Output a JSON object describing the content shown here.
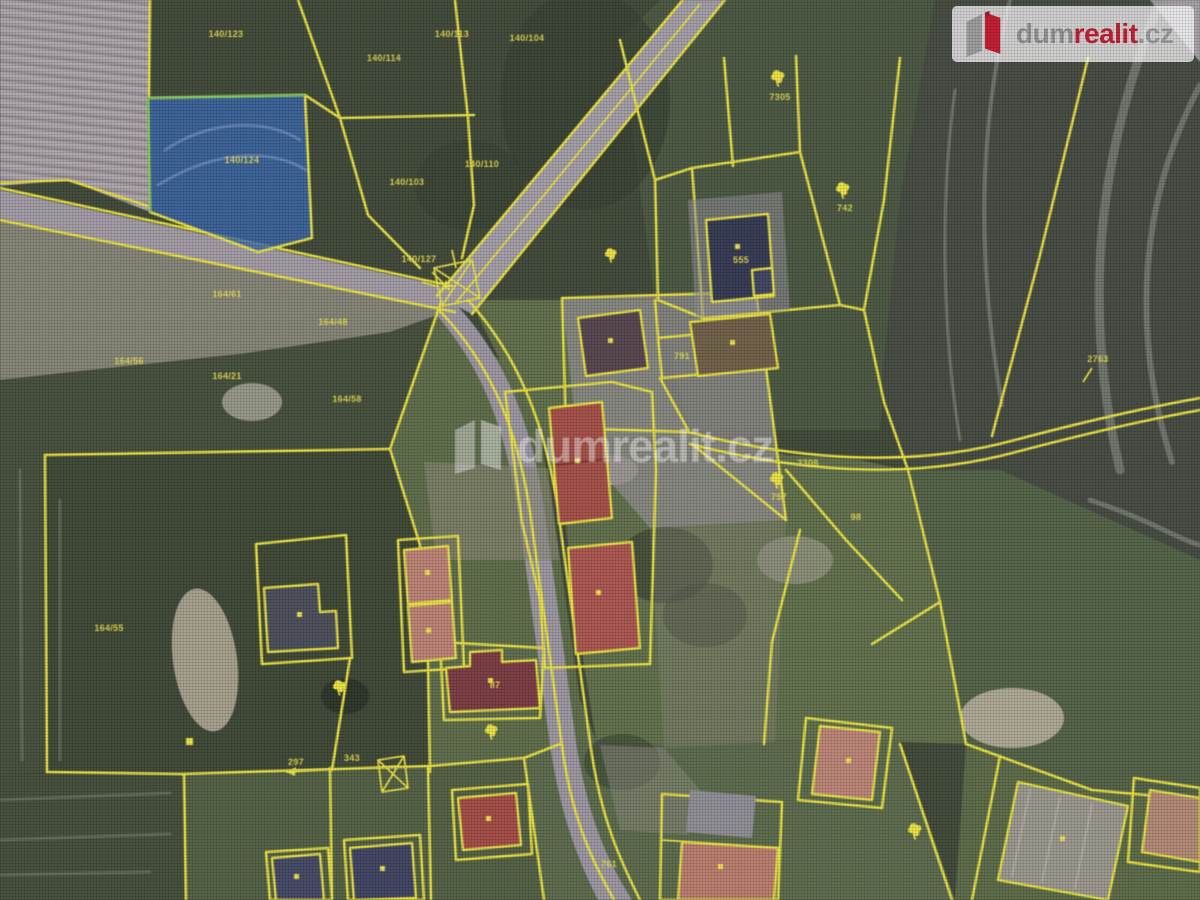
{
  "brand": {
    "logo": {
      "dum": "dum",
      "realit": "realit",
      "tld": ".cz"
    },
    "watermark": {
      "dum": "dum",
      "realit": "realit",
      "tld": ".cz"
    }
  },
  "map": {
    "type": "cadastral-aerial-overlay",
    "highlighted_parcel": {
      "number": "140/124",
      "fill": "#2f64b8",
      "edge": "#84c755"
    },
    "palette": {
      "parcel_line": "#ece42f",
      "field_dark": "#3c4531",
      "road_gray": "#9e98a4",
      "plowed_light": "#a39aa1",
      "building_red": "#aa4a41",
      "logo_red": "#c2182b",
      "logo_gray": "#8d8d91"
    },
    "labels": [
      {
        "t": "140/123",
        "x": 226,
        "y": 37
      },
      {
        "t": "140/114",
        "x": 384,
        "y": 61
      },
      {
        "t": "140/113",
        "x": 452,
        "y": 37
      },
      {
        "t": "140/104",
        "x": 527,
        "y": 41
      },
      {
        "t": "7305",
        "x": 780,
        "y": 100
      },
      {
        "t": "140/124",
        "x": 242,
        "y": 163
      },
      {
        "t": "140/110",
        "x": 482,
        "y": 167
      },
      {
        "t": "140/103",
        "x": 407,
        "y": 185
      },
      {
        "t": "742",
        "x": 845,
        "y": 211
      },
      {
        "t": "140/127",
        "x": 419,
        "y": 262
      },
      {
        "t": "555",
        "x": 741,
        "y": 263
      },
      {
        "t": "164/61",
        "x": 227,
        "y": 297
      },
      {
        "t": "164/48",
        "x": 333,
        "y": 325
      },
      {
        "t": "2763",
        "x": 1098,
        "y": 362
      },
      {
        "t": "164/56",
        "x": 129,
        "y": 364
      },
      {
        "t": "791",
        "x": 682,
        "y": 359
      },
      {
        "t": "164/58",
        "x": 347,
        "y": 402
      },
      {
        "t": "164/21",
        "x": 227,
        "y": 379
      },
      {
        "t": "2308",
        "x": 808,
        "y": 466
      },
      {
        "t": "757",
        "x": 779,
        "y": 500
      },
      {
        "t": "98",
        "x": 856,
        "y": 520
      },
      {
        "t": "164/55",
        "x": 109,
        "y": 631
      },
      {
        "t": "87",
        "x": 495,
        "y": 688
      },
      {
        "t": "297",
        "x": 296,
        "y": 765
      },
      {
        "t": "343",
        "x": 352,
        "y": 761
      },
      {
        "t": "761",
        "x": 609,
        "y": 867
      }
    ]
  }
}
